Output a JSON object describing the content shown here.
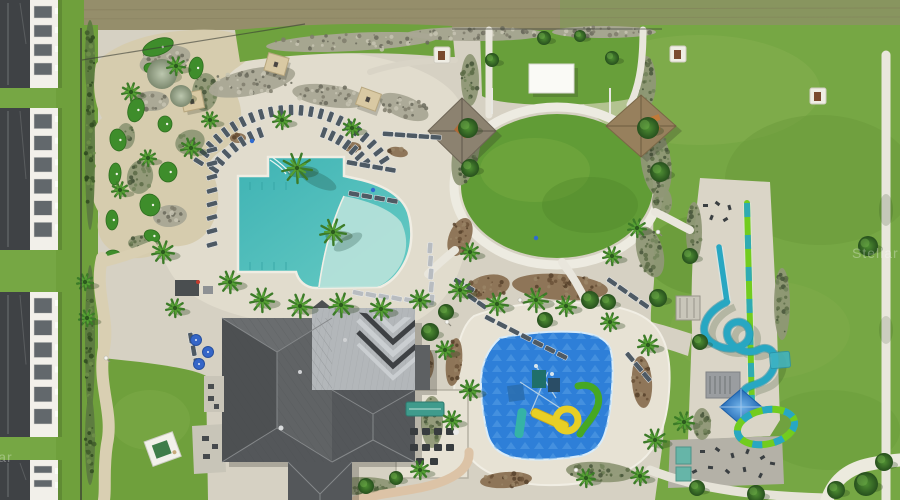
{
  "scene": {
    "type": "aerial-photograph",
    "subject": "resort amenity complex with lagoon pool, splash pad, water slides, mini golf, event lawn and clubhouse"
  },
  "watermark": {
    "text": "Stellar"
  },
  "palette": {
    "grass": "#76a744",
    "grass_dark": "#5f8f33",
    "grass_light": "#8ab152",
    "lawn": "#619c36",
    "dry_field": "#958e6b",
    "concrete": "#d6d1c3",
    "deck": "#e1dccd",
    "deck_bright": "#e7e2d4",
    "path_white": "#edebe1",
    "sand": "#d6ccae",
    "sand_path": "#d9cfb2",
    "pink_path": "#dcc3a6",
    "pool": "#4cbcba",
    "pool_shallow": "#b9e2da",
    "splash": "#2e7fd8",
    "splash_light": "#5aa2e6",
    "roof_dark": "#55585a",
    "roof_light": "#b3b7ba",
    "building": "#f2f0ea",
    "window": "#62686c",
    "putting": "#3e8d2b",
    "palm": "#3c7b28",
    "palm_light": "#55a033",
    "tree": "#2f5e25",
    "thatch": "#8c8270",
    "thatch_tan": "#97805d",
    "canopy_tan": "#d9c9a3",
    "slide_teal": "#28a7c2",
    "slide_green": "#72cc1f",
    "canopy_blue": "#2e7fd0",
    "chair": "#4e5a64",
    "chair_frame": "#e8eaec",
    "umbrella": "#3566c8",
    "teal_mat": "#66b5a8",
    "white": "#f7f6f1"
  },
  "buildings": [
    {
      "y": 0,
      "h": 88,
      "rows": 4
    },
    {
      "y": 108,
      "h": 142,
      "rows": 6
    },
    {
      "y": 292,
      "h": 145,
      "rows": 6
    },
    {
      "y": 460,
      "h": 40,
      "rows": 2
    }
  ],
  "putting_greens": [
    [
      158,
      47,
      16,
      8,
      -20
    ],
    [
      196,
      68,
      7,
      11,
      10
    ],
    [
      150,
      68,
      6,
      5,
      0
    ],
    [
      136,
      110,
      8,
      12,
      15
    ],
    [
      165,
      124,
      7,
      8,
      0
    ],
    [
      118,
      140,
      8,
      11,
      -10
    ],
    [
      168,
      172,
      9,
      10,
      0
    ],
    [
      115,
      174,
      6,
      11,
      5
    ],
    [
      150,
      205,
      10,
      11,
      -15
    ],
    [
      112,
      220,
      6,
      10,
      0
    ],
    [
      152,
      236,
      8,
      6,
      20
    ],
    [
      113,
      256,
      8,
      6,
      0
    ]
  ],
  "planting_beds": [
    [
      165,
      60,
      26,
      13,
      -15,
      "rock"
    ],
    [
      205,
      92,
      13,
      19,
      5,
      "olive"
    ],
    [
      152,
      101,
      17,
      10,
      0,
      "rock"
    ],
    [
      190,
      142,
      15,
      12,
      -20,
      "olive"
    ],
    [
      140,
      177,
      13,
      17,
      10,
      "olive"
    ],
    [
      170,
      216,
      17,
      11,
      -5,
      "rock"
    ],
    [
      126,
      136,
      9,
      13,
      0,
      "olive"
    ],
    [
      143,
      243,
      15,
      8,
      0,
      "olive"
    ],
    [
      252,
      82,
      44,
      13,
      -12,
      "rock"
    ],
    [
      330,
      96,
      38,
      11,
      8,
      "rock"
    ],
    [
      404,
      107,
      26,
      11,
      22,
      "rock"
    ],
    [
      352,
      42,
      86,
      9,
      -3,
      "rock"
    ],
    [
      476,
      34,
      70,
      7,
      0,
      "rock"
    ],
    [
      604,
      32,
      52,
      6,
      0,
      "rock"
    ],
    [
      470,
      80,
      9,
      26,
      0,
      "olive"
    ],
    [
      646,
      82,
      10,
      26,
      0,
      "olive"
    ],
    [
      466,
      152,
      13,
      34,
      12,
      "olive"
    ],
    [
      656,
      162,
      15,
      36,
      -8,
      "olive"
    ],
    [
      460,
      237,
      11,
      20,
      22,
      "mulch"
    ],
    [
      650,
      252,
      13,
      26,
      -15,
      "olive"
    ],
    [
      560,
      287,
      48,
      13,
      4,
      "mulch"
    ],
    [
      488,
      287,
      22,
      12,
      -12,
      "mulch"
    ],
    [
      238,
      138,
      8,
      5,
      0,
      "mulch"
    ],
    [
      352,
      147,
      9,
      5,
      0,
      "mulch"
    ],
    [
      398,
      152,
      10,
      5,
      10,
      "mulch"
    ],
    [
      454,
      362,
      8,
      24,
      6,
      "mulch"
    ],
    [
      642,
      382,
      10,
      26,
      -4,
      "mulch"
    ],
    [
      600,
      472,
      34,
      10,
      4,
      "olive"
    ],
    [
      506,
      480,
      26,
      8,
      -4,
      "mulch"
    ],
    [
      432,
      422,
      11,
      26,
      0,
      "olive"
    ],
    [
      424,
      364,
      10,
      18,
      0,
      "mulch"
    ],
    [
      694,
      232,
      8,
      30,
      0,
      "olive"
    ],
    [
      782,
      304,
      8,
      36,
      0,
      "olive"
    ],
    [
      702,
      424,
      9,
      16,
      0,
      "olive"
    ],
    [
      662,
      202,
      10,
      15,
      0,
      "olive"
    ],
    [
      362,
      486,
      34,
      9,
      0,
      "olive"
    ],
    [
      258,
      332,
      26,
      7,
      -4,
      "mulch"
    ],
    [
      310,
      486,
      20,
      7,
      0,
      "mulch"
    ],
    [
      90,
      150,
      5,
      80,
      0,
      "hedge"
    ],
    [
      90,
      340,
      5,
      75,
      0,
      "hedge"
    ],
    [
      90,
      60,
      5,
      40,
      0,
      "hedge"
    ],
    [
      90,
      440,
      5,
      45,
      0,
      "hedge"
    ]
  ],
  "palms": [
    [
      297,
      168,
      15
    ],
    [
      333,
      232,
      13
    ],
    [
      262,
      300,
      12
    ],
    [
      300,
      306,
      12
    ],
    [
      341,
      305,
      12
    ],
    [
      381,
      309,
      11
    ],
    [
      420,
      300,
      10
    ],
    [
      191,
      148,
      10
    ],
    [
      163,
      252,
      11
    ],
    [
      230,
      282,
      11
    ],
    [
      131,
      92,
      9
    ],
    [
      176,
      66,
      9
    ],
    [
      120,
      190,
      8
    ],
    [
      460,
      290,
      11
    ],
    [
      497,
      304,
      11
    ],
    [
      536,
      300,
      12
    ],
    [
      566,
      306,
      10
    ],
    [
      470,
      252,
      9
    ],
    [
      610,
      322,
      9
    ],
    [
      648,
      345,
      10
    ],
    [
      655,
      440,
      11
    ],
    [
      684,
      422,
      10
    ],
    [
      175,
      308,
      9
    ],
    [
      85,
      282,
      8
    ],
    [
      87,
      318,
      8
    ],
    [
      445,
      350,
      9
    ],
    [
      612,
      256,
      9
    ],
    [
      637,
      228,
      9
    ],
    [
      210,
      120,
      8
    ],
    [
      148,
      158,
      8
    ],
    [
      282,
      120,
      9
    ],
    [
      352,
      128,
      9
    ],
    [
      470,
      390,
      10
    ],
    [
      452,
      420,
      9
    ],
    [
      420,
      470,
      9
    ],
    [
      586,
      478,
      9
    ],
    [
      640,
      476,
      9
    ]
  ],
  "trees": [
    [
      468,
      128,
      10
    ],
    [
      648,
      128,
      11
    ],
    [
      660,
      172,
      10
    ],
    [
      470,
      168,
      9
    ],
    [
      492,
      60,
      7
    ],
    [
      612,
      58,
      7
    ],
    [
      590,
      300,
      9
    ],
    [
      545,
      320,
      8
    ],
    [
      608,
      302,
      8
    ],
    [
      658,
      298,
      9
    ],
    [
      430,
      332,
      9
    ],
    [
      446,
      312,
      8
    ],
    [
      366,
      486,
      8
    ],
    [
      396,
      478,
      7
    ],
    [
      690,
      256,
      8
    ],
    [
      700,
      342,
      8
    ],
    [
      866,
      484,
      12
    ],
    [
      836,
      490,
      9
    ],
    [
      756,
      494,
      9
    ],
    [
      697,
      488,
      8
    ],
    [
      868,
      246,
      10
    ],
    [
      884,
      462,
      9
    ],
    [
      544,
      38,
      7
    ],
    [
      580,
      36,
      6
    ]
  ],
  "silver_trees": [
    [
      162,
      74,
      15
    ],
    [
      181,
      96,
      11
    ]
  ],
  "chair_arcs": [
    {
      "cx": 292,
      "cy": 220,
      "r": 110,
      "a0": -148,
      "a1": -33,
      "n": 23
    },
    {
      "cx": 292,
      "cy": 220,
      "r": 93,
      "a0": -147,
      "a1": -110,
      "n": 7
    },
    {
      "cx": 292,
      "cy": 220,
      "r": 93,
      "a0": -70,
      "a1": -38,
      "n": 7
    }
  ],
  "chair_rows": [
    [
      212,
      150,
      90,
      8,
      13.5,
      75
    ],
    [
      352,
      163,
      10,
      4,
      13,
      100
    ],
    [
      354,
      194,
      10,
      4,
      13,
      100
    ],
    [
      358,
      293,
      8,
      6,
      13,
      -78
    ],
    [
      388,
      134,
      4,
      5,
      12,
      94
    ],
    [
      430,
      248,
      88,
      5,
      13,
      5
    ],
    [
      490,
      319,
      27,
      7,
      13.5,
      117
    ],
    [
      612,
      282,
      35,
      4,
      13,
      125
    ],
    [
      459,
      282,
      30,
      2,
      12,
      120
    ],
    [
      472,
      298,
      35,
      2,
      12,
      125
    ],
    [
      191,
      338,
      78,
      3,
      13,
      -10
    ],
    [
      630,
      357,
      50,
      3,
      13,
      140
    ]
  ],
  "canopies": [
    [
      276,
      64,
      16
    ],
    [
      192,
      101,
      -12
    ],
    [
      368,
      99,
      20
    ]
  ],
  "blue_umbrellas": [
    [
      196,
      340
    ],
    [
      208,
      352
    ],
    [
      199,
      364
    ]
  ],
  "grill_pads": [
    [
      670,
      46
    ],
    [
      810,
      88
    ],
    [
      434,
      47
    ]
  ],
  "accent_dots": [
    [
      252,
      141
    ],
    [
      373,
      190
    ],
    [
      536,
      238
    ]
  ],
  "light_poles": [
    [
      447,
      322
    ],
    [
      576,
      470
    ],
    [
      520,
      300
    ],
    [
      658,
      232
    ],
    [
      106,
      358
    ]
  ],
  "fitness": {
    "top": {
      "x": 695,
      "y": 196,
      "items": [
        [
          8,
          8
        ],
        [
          20,
          6
        ],
        [
          32,
          10
        ],
        [
          14,
          20
        ],
        [
          28,
          22
        ]
      ]
    },
    "bottom": {
      "x": 670,
      "y": 440,
      "items": [
        [
          30,
          10
        ],
        [
          45,
          8
        ],
        [
          60,
          14
        ],
        [
          75,
          10
        ],
        [
          90,
          16
        ],
        [
          38,
          26
        ],
        [
          55,
          30
        ],
        [
          72,
          28
        ],
        [
          88,
          34
        ],
        [
          22,
          30
        ],
        [
          100,
          22
        ]
      ]
    }
  }
}
